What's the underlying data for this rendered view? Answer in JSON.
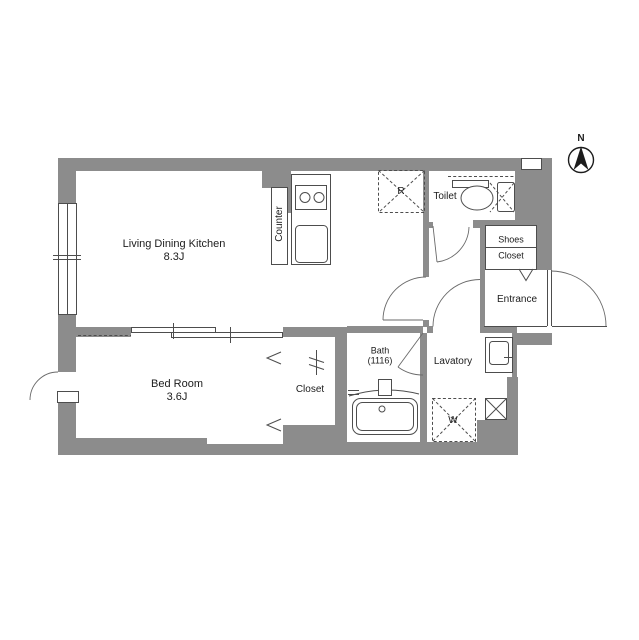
{
  "plan": {
    "compass": {
      "label": "N"
    },
    "rooms": {
      "ldk": {
        "name": "Living Dining Kitchen",
        "size": "8.3J"
      },
      "bedroom": {
        "name": "Bed Room",
        "size": "3.6J"
      },
      "closet": {
        "name": "Closet"
      },
      "bath": {
        "name": "Bath",
        "size": "(1116)"
      },
      "lavatory": {
        "name": "Lavatory"
      },
      "toilet": {
        "name": "Toilet"
      },
      "shoes_closet": {
        "line1": "Shoes",
        "line2": "Closet"
      },
      "entrance": {
        "name": "Entrance"
      }
    },
    "fixtures": {
      "counter": "Counter",
      "refrigerator_mark": "R",
      "washer_mark": "W"
    },
    "colors": {
      "wall": "#8c8c8c",
      "line": "#4d4d4d",
      "text": "#1c1c1c"
    }
  }
}
